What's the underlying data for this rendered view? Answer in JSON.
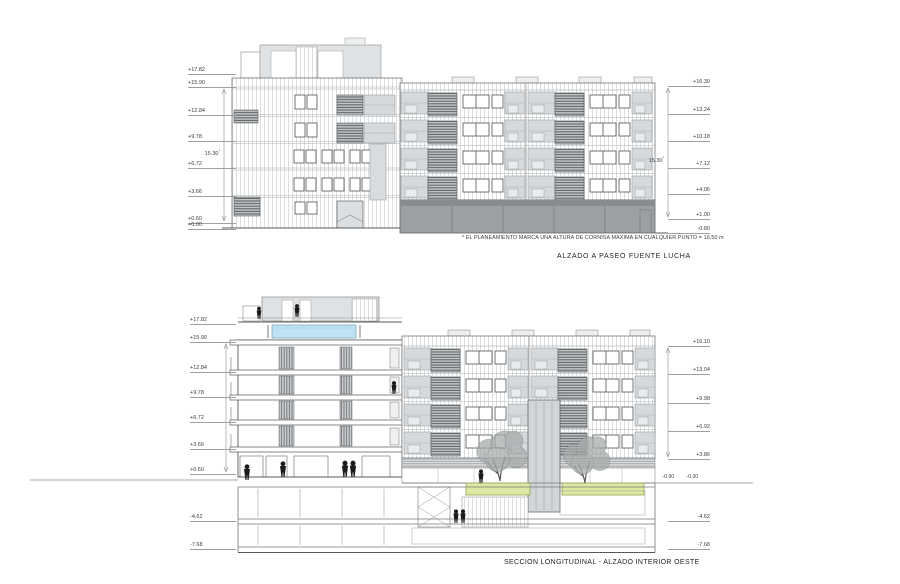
{
  "page": {
    "background": "#ffffff"
  },
  "colors": {
    "line": "#666666",
    "siding": "#cdd1d3",
    "panel": "#d6d9db",
    "panel_dark": "#9ba0a4",
    "louver": "#5f6466",
    "pool": "#bfe3f2",
    "green": "#dde8a2",
    "tree": "#a6abab",
    "figure": "#1b1b1b"
  },
  "elevation": {
    "title": "ALZADO A PASEO FUENTE  LUCHA",
    "footnote": "* EL PLANEAMIENTO MARCA UNA ALTURA DE CORNISA MAXIMA EN CUALQUIER PUNTO = 16,50 m",
    "height_dim_left": "15.30",
    "height_dim_right": "15.30",
    "asterisk": "*",
    "levels_left": [
      {
        "label": "+17.82",
        "y": 74
      },
      {
        "label": "+15.90",
        "y": 87
      },
      {
        "label": "+12.84",
        "y": 115
      },
      {
        "label": "+9.78",
        "y": 141
      },
      {
        "label": "+6.72",
        "y": 168
      },
      {
        "label": "+3.66",
        "y": 196
      },
      {
        "label": "+0.60",
        "y": 223
      },
      {
        "label": "+0.00",
        "y": 229
      }
    ],
    "levels_right": [
      {
        "label": "+16.30",
        "y": 86
      },
      {
        "label": "+13.24",
        "y": 114
      },
      {
        "label": "+10.18",
        "y": 141
      },
      {
        "label": "+7.12",
        "y": 168
      },
      {
        "label": "+4.06",
        "y": 194
      },
      {
        "label": "+1.00",
        "y": 219
      },
      {
        "label": "-0.80",
        "y": 233
      }
    ]
  },
  "section": {
    "title": "SECCION LONGITUDINAL - ALZADO INTERIOR OESTE",
    "levels_left": [
      {
        "label": "+17.82",
        "y": 324
      },
      {
        "label": "+15.90",
        "y": 342
      },
      {
        "label": "+12.84",
        "y": 372
      },
      {
        "label": "+9.78",
        "y": 397
      },
      {
        "label": "+6.72",
        "y": 422
      },
      {
        "label": "+3.66",
        "y": 449
      },
      {
        "label": "+0.60",
        "y": 474
      },
      {
        "label": "-4.62",
        "y": 521
      },
      {
        "label": "-7.68",
        "y": 549
      }
    ],
    "levels_right": [
      {
        "label": "+16.10",
        "y": 346
      },
      {
        "label": "+13.04",
        "y": 374
      },
      {
        "label": "+9.98",
        "y": 403
      },
      {
        "label": "+6.92",
        "y": 431
      },
      {
        "label": "+3.86",
        "y": 459
      },
      {
        "label": "-4.62",
        "y": 521
      },
      {
        "label": "-7.68",
        "y": 549
      }
    ],
    "ground_labels": {
      "left": "-0.90",
      "right": "-0.30"
    }
  }
}
